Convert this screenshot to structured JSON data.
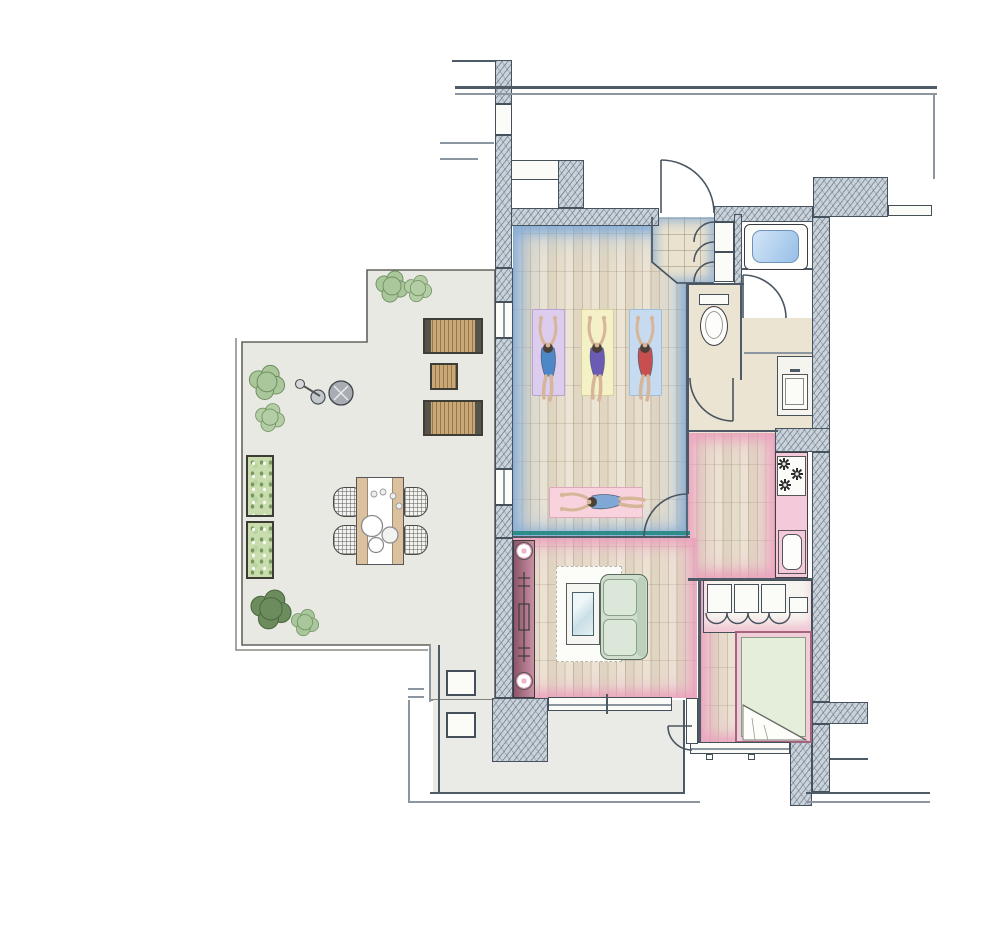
{
  "meta": {
    "title": "hand-drawn watercolor apartment floor plan with yoga studio and terrace",
    "type": "architectural-floor-plan",
    "canvas": "1000x943",
    "orientation": "top-down"
  },
  "palette": {
    "wall_hatch": "#cbd3da",
    "wall_line": "#46525e",
    "wood_floor": "#e7ddcb",
    "wood_grain": "#8b785c",
    "terrace_floor": "#e9e9e3",
    "blue_wash": "#74a3d6",
    "pink_wash": "#e994b7",
    "teal_partition": "#2e8d88",
    "tub_water": "#96bfe8",
    "sofa_green": "#cfdecf",
    "duvet_green": "#e4eedb",
    "mat_lavender": "#dccdee",
    "mat_yellow": "#f5f1c6",
    "mat_blue": "#c6dbef",
    "mat_pink": "#f8d2dd",
    "plant_green": "#a9c79a",
    "plant_dark": "#6d8c5e",
    "lounger_wood": "#c9a876",
    "console_maroon": "#8e5468"
  },
  "rooms": [
    {
      "id": "yoga-studio",
      "label": "yoga studio",
      "floor": "light wood planks",
      "accent": "blue watercolor wash",
      "contents": [
        "yoga-mat-lavender",
        "yoga-mat-yellow",
        "yoga-mat-blue",
        "yoga-mat-pink"
      ]
    },
    {
      "id": "entry-vestibule",
      "label": "entry",
      "floor": "beige tile",
      "contents": [
        "entry-door",
        "shoe-closet-with-3-doors"
      ]
    },
    {
      "id": "bathroom",
      "label": "bathroom",
      "contents": [
        "bathtub"
      ]
    },
    {
      "id": "toilet-room",
      "label": "wc",
      "contents": [
        "toilet"
      ]
    },
    {
      "id": "washroom",
      "label": "washroom",
      "floor": "beige",
      "contents": [
        "vanity-sink"
      ]
    },
    {
      "id": "kitchen",
      "label": "kitchen",
      "floor": "wood planks",
      "accent": "pink watercolor wash",
      "contents": [
        "stove-3-burners",
        "counter",
        "kitchen-sink"
      ]
    },
    {
      "id": "living-room",
      "label": "living room",
      "floor": "wood planks",
      "accent": "pink watercolor wash",
      "contents": [
        "media-console",
        "rug",
        "coffee-table",
        "sofa"
      ]
    },
    {
      "id": "bedroom",
      "label": "bedroom",
      "floor": "wood planks",
      "accent": "pink watercolor wash",
      "contents": [
        "wardrobe",
        "double-bed"
      ]
    },
    {
      "id": "terrace",
      "label": "terrace",
      "floor": "light gray stone",
      "contents": [
        "2 shrub clusters top",
        "2 shrubs left",
        "2 planter boxes",
        "2 shrubs bottom",
        "grill",
        "2 sun loungers",
        "side table",
        "dining table with 4 wicker chairs"
      ]
    },
    {
      "id": "balcony",
      "label": "balcony",
      "contents": [
        "2 small planters",
        "structural pillar"
      ]
    }
  ],
  "figures": [
    {
      "id": "figure-1",
      "pose": "prone stretch",
      "mat": "lavender",
      "outfit_color": "#4d87c7"
    },
    {
      "id": "figure-2",
      "pose": "prone stretch",
      "mat": "yellow",
      "outfit_color": "#6b5bb5"
    },
    {
      "id": "figure-3",
      "pose": "prone stretch",
      "mat": "blue",
      "outfit_color": "#c94f4f"
    },
    {
      "id": "figure-4",
      "pose": "lying on back",
      "mat": "pink",
      "outfit_color": "#7fa8d6"
    }
  ],
  "counts": {
    "yoga_mats": 4,
    "people": 4,
    "dining_chairs": 4,
    "dining_plates": 3,
    "sun_loungers": 2,
    "stove_burners": 3,
    "wardrobe_sections": 4,
    "planter_boxes_terrace": 2,
    "planters_balcony": 2,
    "shrubs": 6,
    "swing_doors": 7
  }
}
